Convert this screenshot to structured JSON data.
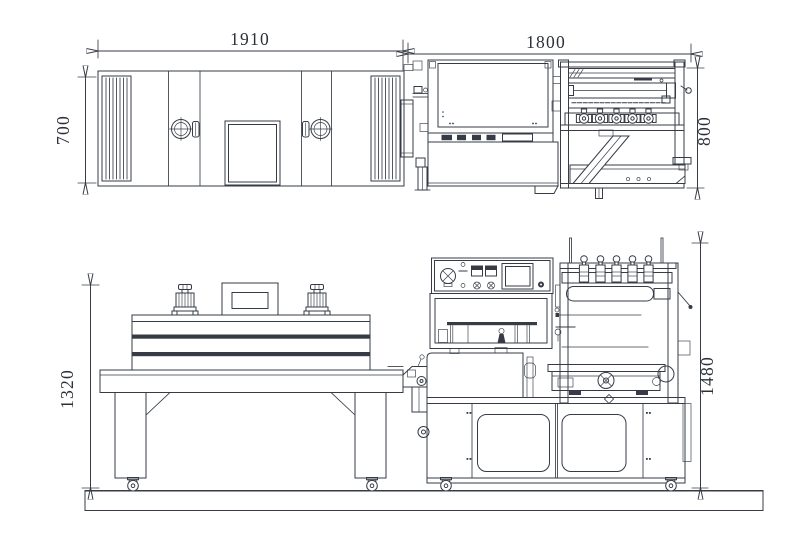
{
  "drawing": {
    "dimensions": {
      "tunnel_top_width": "1910",
      "sealer_top_width": "1800",
      "tunnel_top_depth": "700",
      "sealer_top_depth": "800",
      "tunnel_height": "1320",
      "sealer_height": "1480"
    }
  }
}
